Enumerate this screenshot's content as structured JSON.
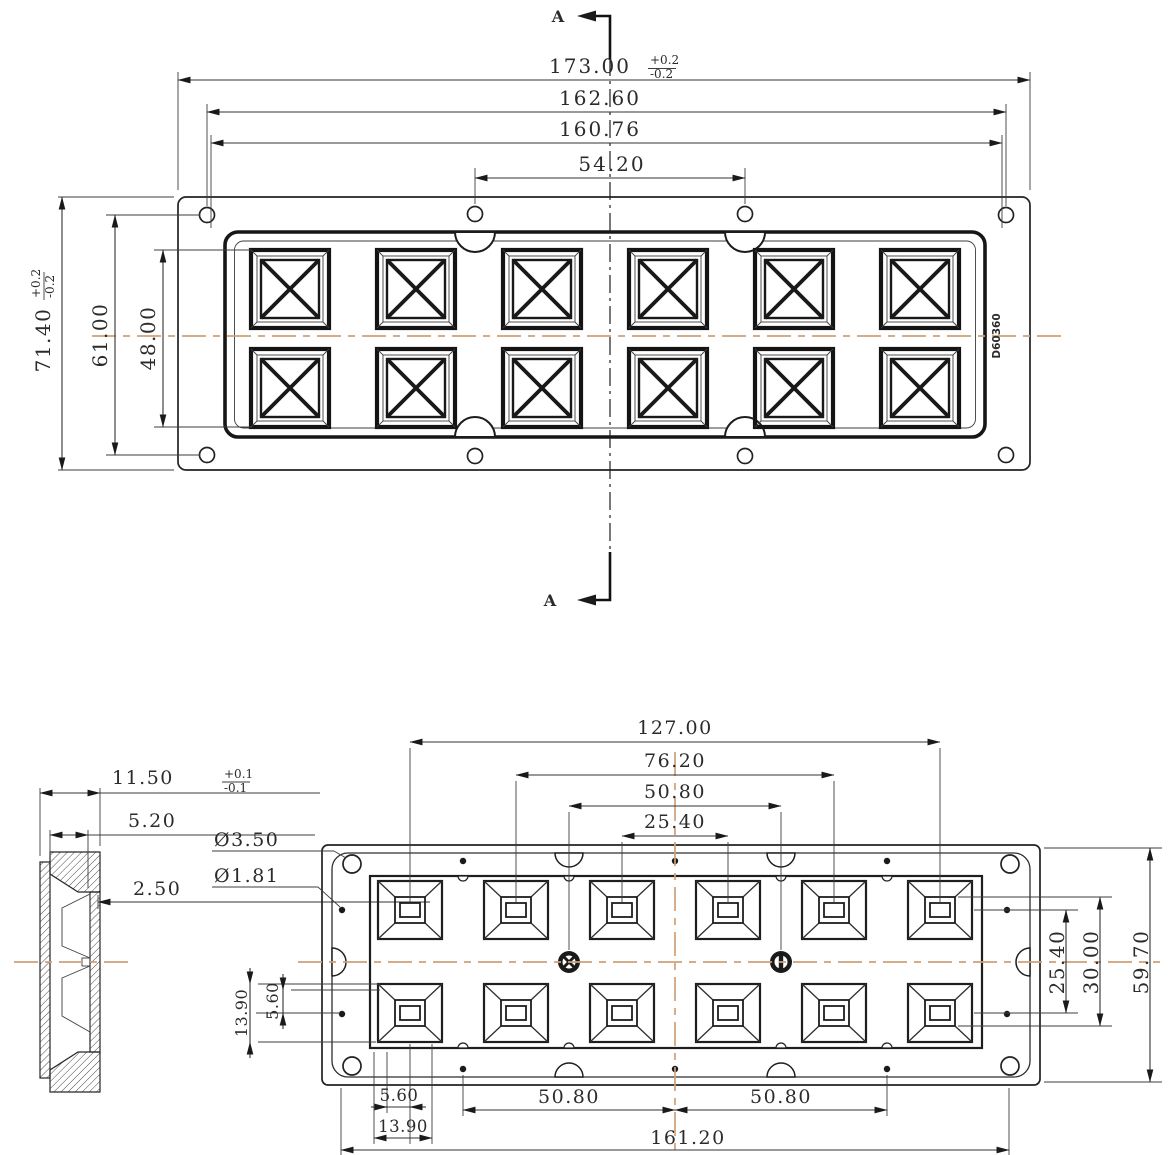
{
  "drawing": {
    "part_label": "D60360",
    "section": {
      "top": "A",
      "bottom": "A"
    },
    "lens_grid": {
      "rows": 2,
      "cols": 6
    },
    "top_view": {
      "dim_width_overall": "173.00",
      "width_tol_plus": "+0.2",
      "width_tol_minus": "-0.2",
      "dim_width_holes": "162.60",
      "dim_width_frame": "160.76",
      "dim_hole_pitch": "54.20",
      "dim_height_overall": "71.40",
      "height_tol_plus": "+0.2",
      "height_tol_minus": "-0.2",
      "dim_height_holes": "61.00",
      "dim_height_lens": "48.00"
    },
    "side_view": {
      "dim_depth": "11.50",
      "depth_tol_plus": "+0.1",
      "depth_tol_minus": "-0.1",
      "dim_step": "5.20",
      "dim_wall": "2.50"
    },
    "bottom_view": {
      "dim_span_6": "127.00",
      "dim_span_4": "76.20",
      "dim_pin_span": "50.80",
      "dim_pitch": "25.40",
      "dim_hole_dia": "Ø3.50",
      "dim_pin_dia": "Ø1.81",
      "dim_left_outer": "13.90",
      "dim_left_inner": "5.60",
      "dim_bottom_inner": "5.60",
      "dim_bottom_outer": "13.90",
      "dim_bottom_left_span": "50.80",
      "dim_bottom_right_span": "50.80",
      "dim_bottom_overall": "161.20",
      "dim_row_pitch": "25.40",
      "dim_row_span": "30.00",
      "dim_height_span": "59.70"
    }
  }
}
